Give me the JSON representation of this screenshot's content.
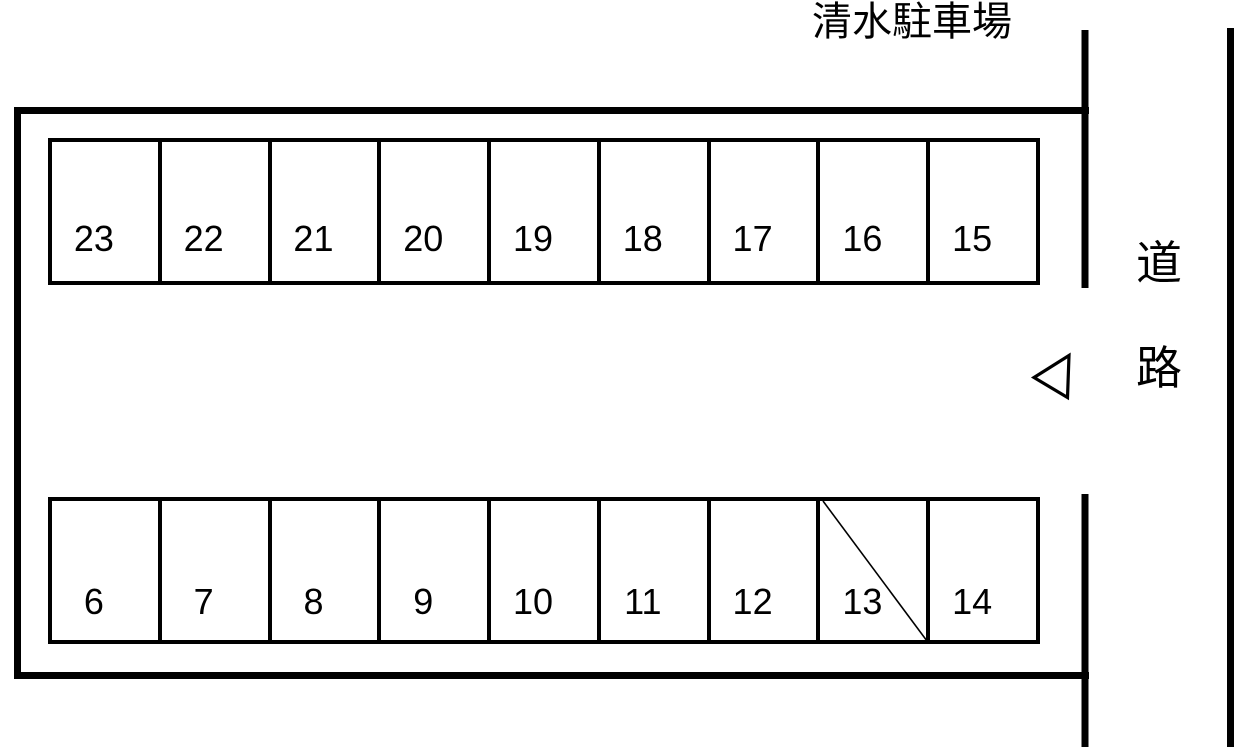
{
  "title": "清水駐車場",
  "road_label": {
    "top_char": "道",
    "bottom_char": "路"
  },
  "entrance": {
    "arrow_direction": "left",
    "arrow_shape": "hollow-triangle"
  },
  "crossed_out_space": "13",
  "rows": {
    "top": {
      "spaces": [
        {
          "label": "23"
        },
        {
          "label": "22"
        },
        {
          "label": "21"
        },
        {
          "label": "20"
        },
        {
          "label": "19"
        },
        {
          "label": "18"
        },
        {
          "label": "17"
        },
        {
          "label": "16"
        },
        {
          "label": "15"
        }
      ]
    },
    "bottom": {
      "spaces": [
        {
          "label": "6"
        },
        {
          "label": "7"
        },
        {
          "label": "8"
        },
        {
          "label": "9"
        },
        {
          "label": "10"
        },
        {
          "label": "11"
        },
        {
          "label": "12"
        },
        {
          "label": "13",
          "crossed_out": true
        },
        {
          "label": "14"
        }
      ]
    }
  },
  "colors": {
    "line": "#000000",
    "background": "#ffffff",
    "text": "#000000"
  }
}
